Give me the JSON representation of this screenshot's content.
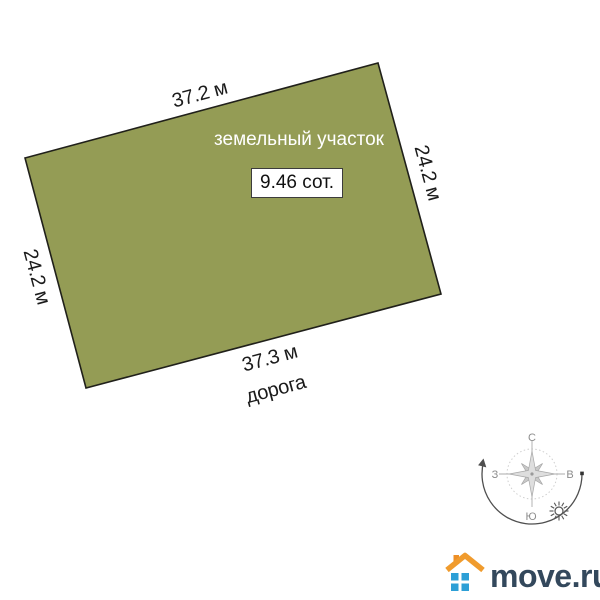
{
  "plot": {
    "title": "земельный участок",
    "area_label": "9.46 сот.",
    "top_length": "37.2 м",
    "bottom_length": "37.3 м",
    "left_length": "24.2 м",
    "right_length": "24.2 м",
    "road_label": "дорога",
    "fill_color": "#949c55",
    "stroke_color": "#20201a"
  },
  "compass": {
    "north": "С",
    "south": "Ю",
    "west": "З",
    "east": "В"
  },
  "logo": {
    "text": "move.ru",
    "roof_color": "#f09b2d",
    "chimney_color": "#ee8f26",
    "window_color": "#2d9fd6",
    "text_color": "#33485c"
  }
}
